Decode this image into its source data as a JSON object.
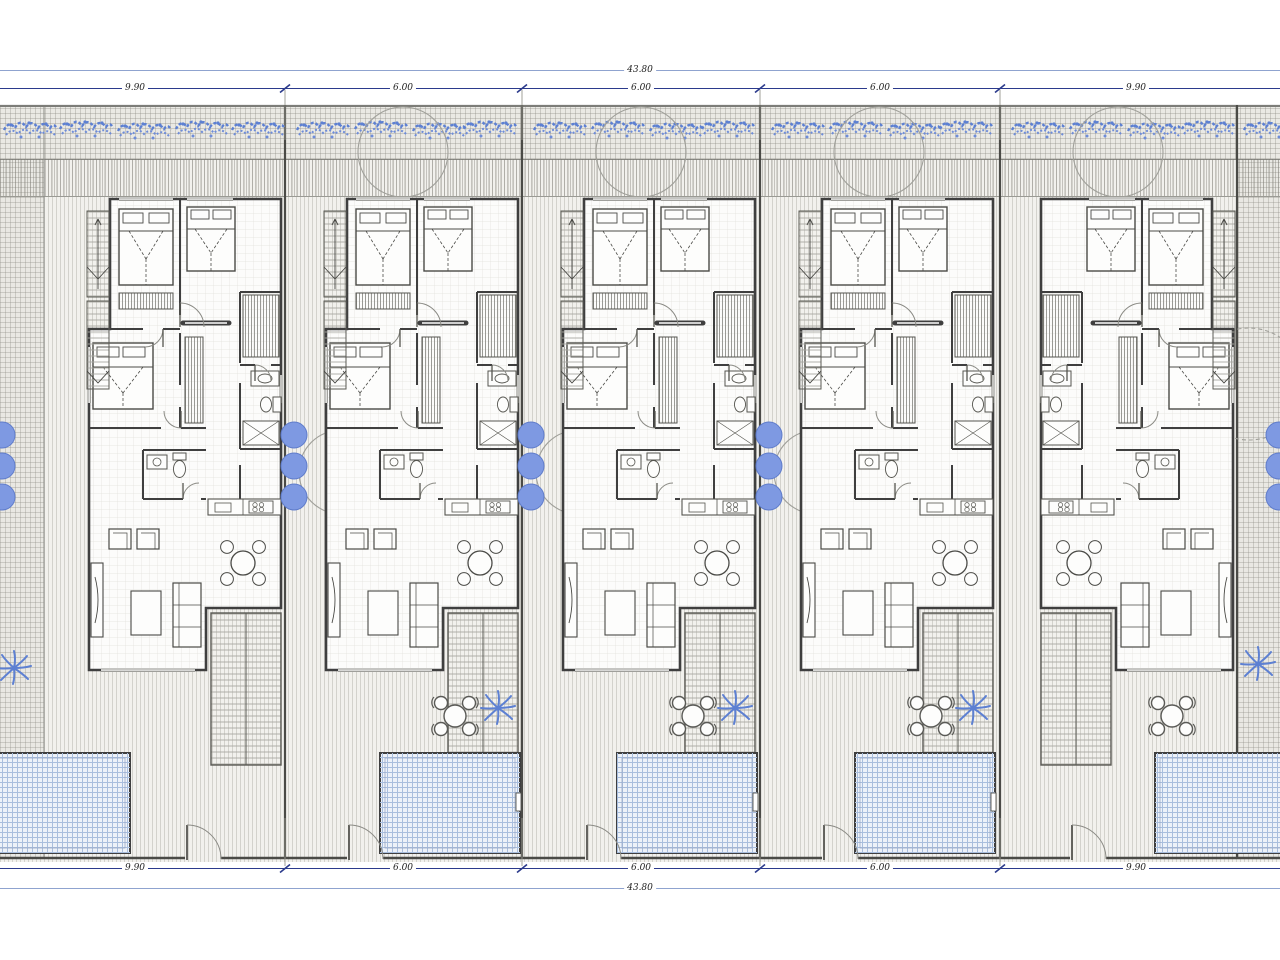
{
  "drawing": {
    "kind": "architectural site plan, ground floor, five attached villas with pools"
  },
  "dimensions": {
    "top": {
      "total": "43.80",
      "segments": [
        "9.90",
        "6.00",
        "6.00",
        "6.00",
        "9.90"
      ]
    },
    "bottom": {
      "total": "43.80",
      "segments": [
        "9.90",
        "6.00",
        "6.00",
        "6.00",
        "9.90"
      ]
    }
  },
  "colors": {
    "dimension_navy": "#2b3a8c",
    "dimension_light_blue": "#8fa3cf",
    "foliage_blue": "#5d80d2",
    "bush_blue": "#7e99e2",
    "pool_hatch_blue": "#a9bedd",
    "wall_gray": "#3f3f3f",
    "ground_hatch_gray": "#d8d6d1"
  },
  "symbols": {
    "palm_plant": "palm-plant-icon",
    "bush": "bush-icon",
    "tree_canopy": "tree-canopy-icon",
    "hedge_strip": "hedge-foliage-icon",
    "pool": "pool-icon",
    "outdoor_table": "outdoor-table-icon",
    "gate": "gate-icon",
    "stair": "stair-icon",
    "double_bed": "double-bed-icon",
    "sofa": "sofa-icon",
    "dining_table": "dining-table-icon"
  }
}
